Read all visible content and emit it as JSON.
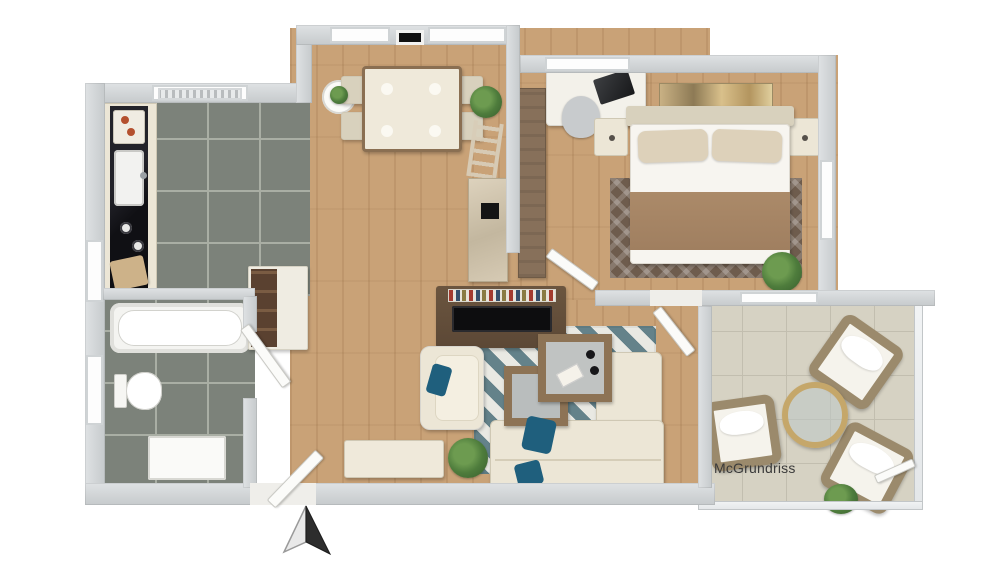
{
  "watermark": {
    "text": "McGrundriss"
  },
  "compass": {
    "icon": "north-arrow",
    "points": "up"
  },
  "scene": {
    "type": "3d-floor-plan-top-view",
    "rooms": [
      "kitchen",
      "bathroom",
      "living-dining-room",
      "bedroom",
      "winter-garden-terrace"
    ]
  },
  "palette": {
    "wall": "#c6cacc",
    "wood-floor": "#c9a277",
    "kitchen-bath-tile": "#7c827a",
    "terrace-tile": "#d6d2c3",
    "countertop-black": "#1d1d22",
    "cabinet-cream": "#ece6d6",
    "tv-console-walnut": "#5c4836",
    "wardrobe-brown": "#87705a",
    "accent-teal": "#1f5f7d",
    "rug-teal": "#64828a",
    "bedroom-rug-brown": "#6e5c4d",
    "blanket-brown": "#a07f60",
    "plant-green": "#4e7c3c",
    "wicker-brown": "#9b8a6c",
    "watermark-text": "#3a3a3a"
  }
}
